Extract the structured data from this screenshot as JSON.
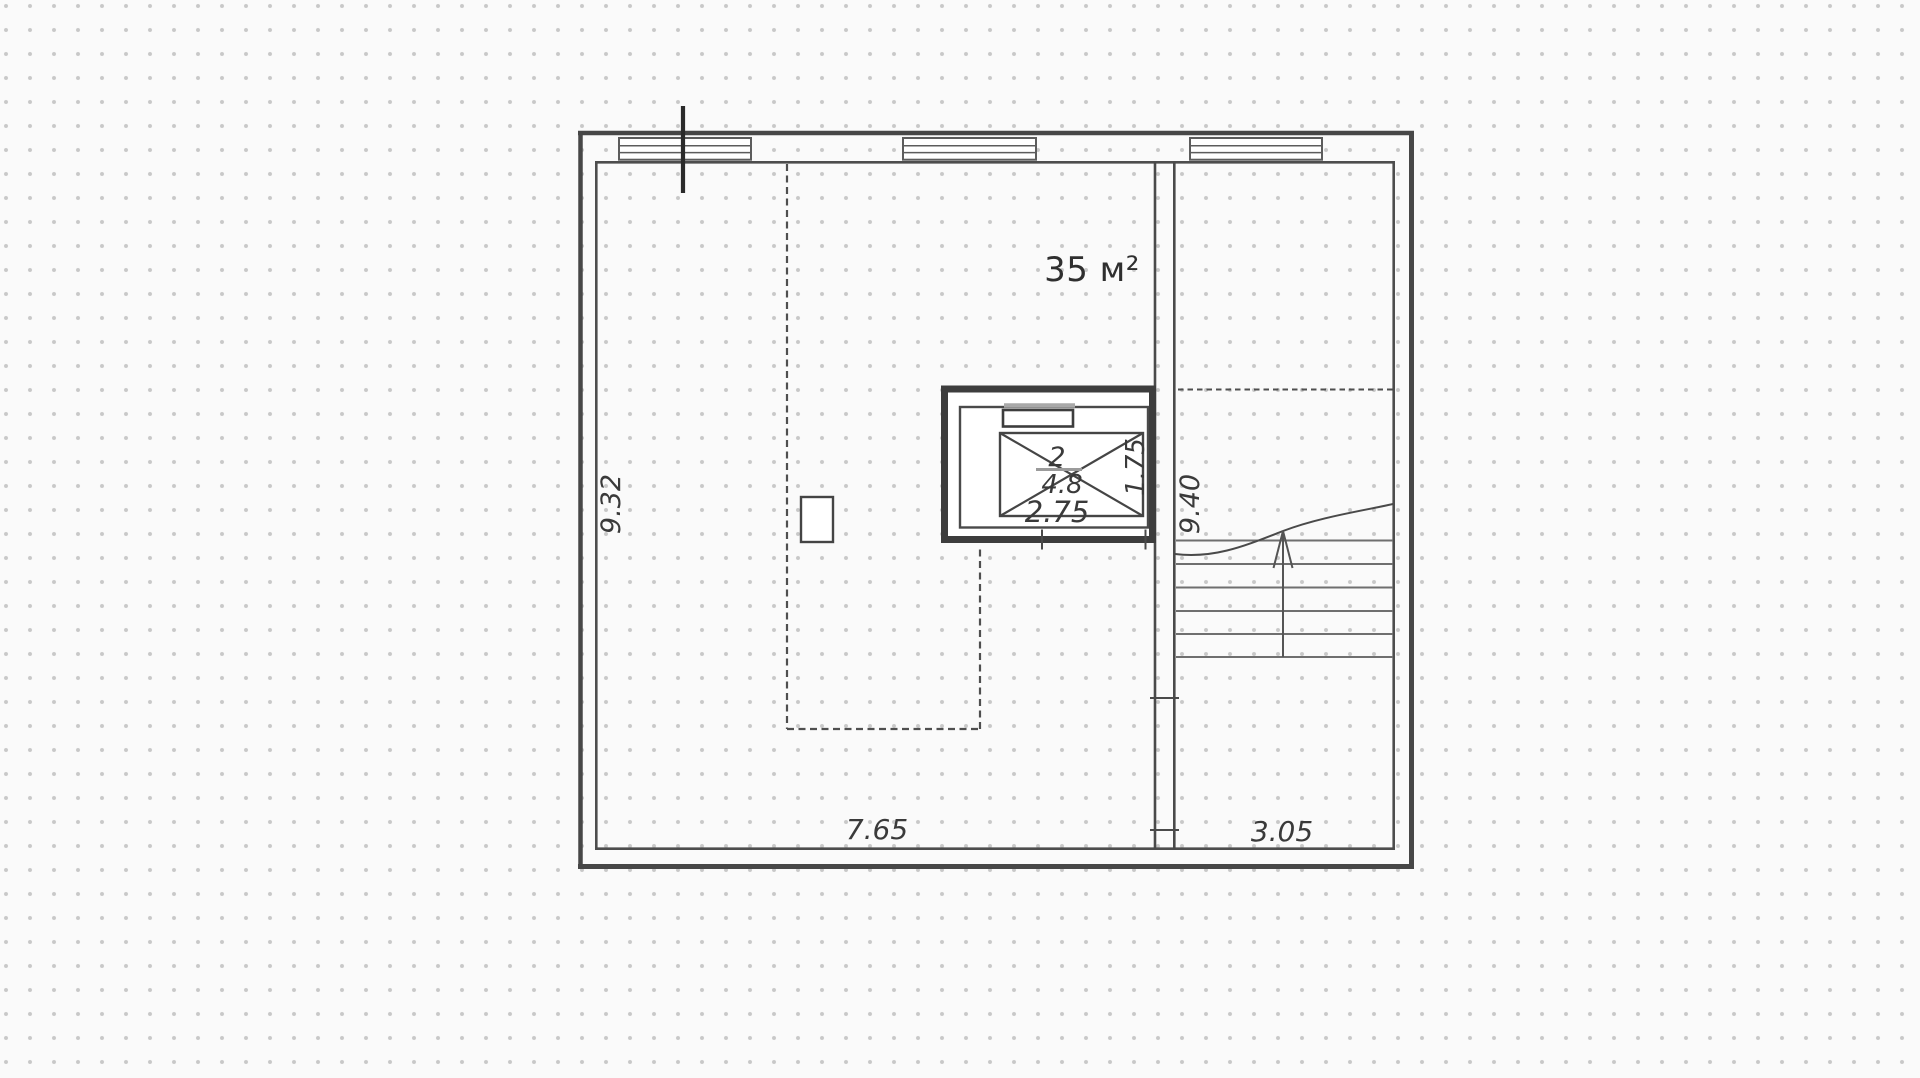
{
  "plan": {
    "area_label": "35 м²",
    "dims": {
      "left": "9.32",
      "stairwell": "9.40",
      "bottom_main": "7.65",
      "bottom_right": "3.05"
    },
    "elevator": {
      "number": "2",
      "area": "4.8",
      "width": "2.75",
      "depth": "1.75"
    }
  }
}
